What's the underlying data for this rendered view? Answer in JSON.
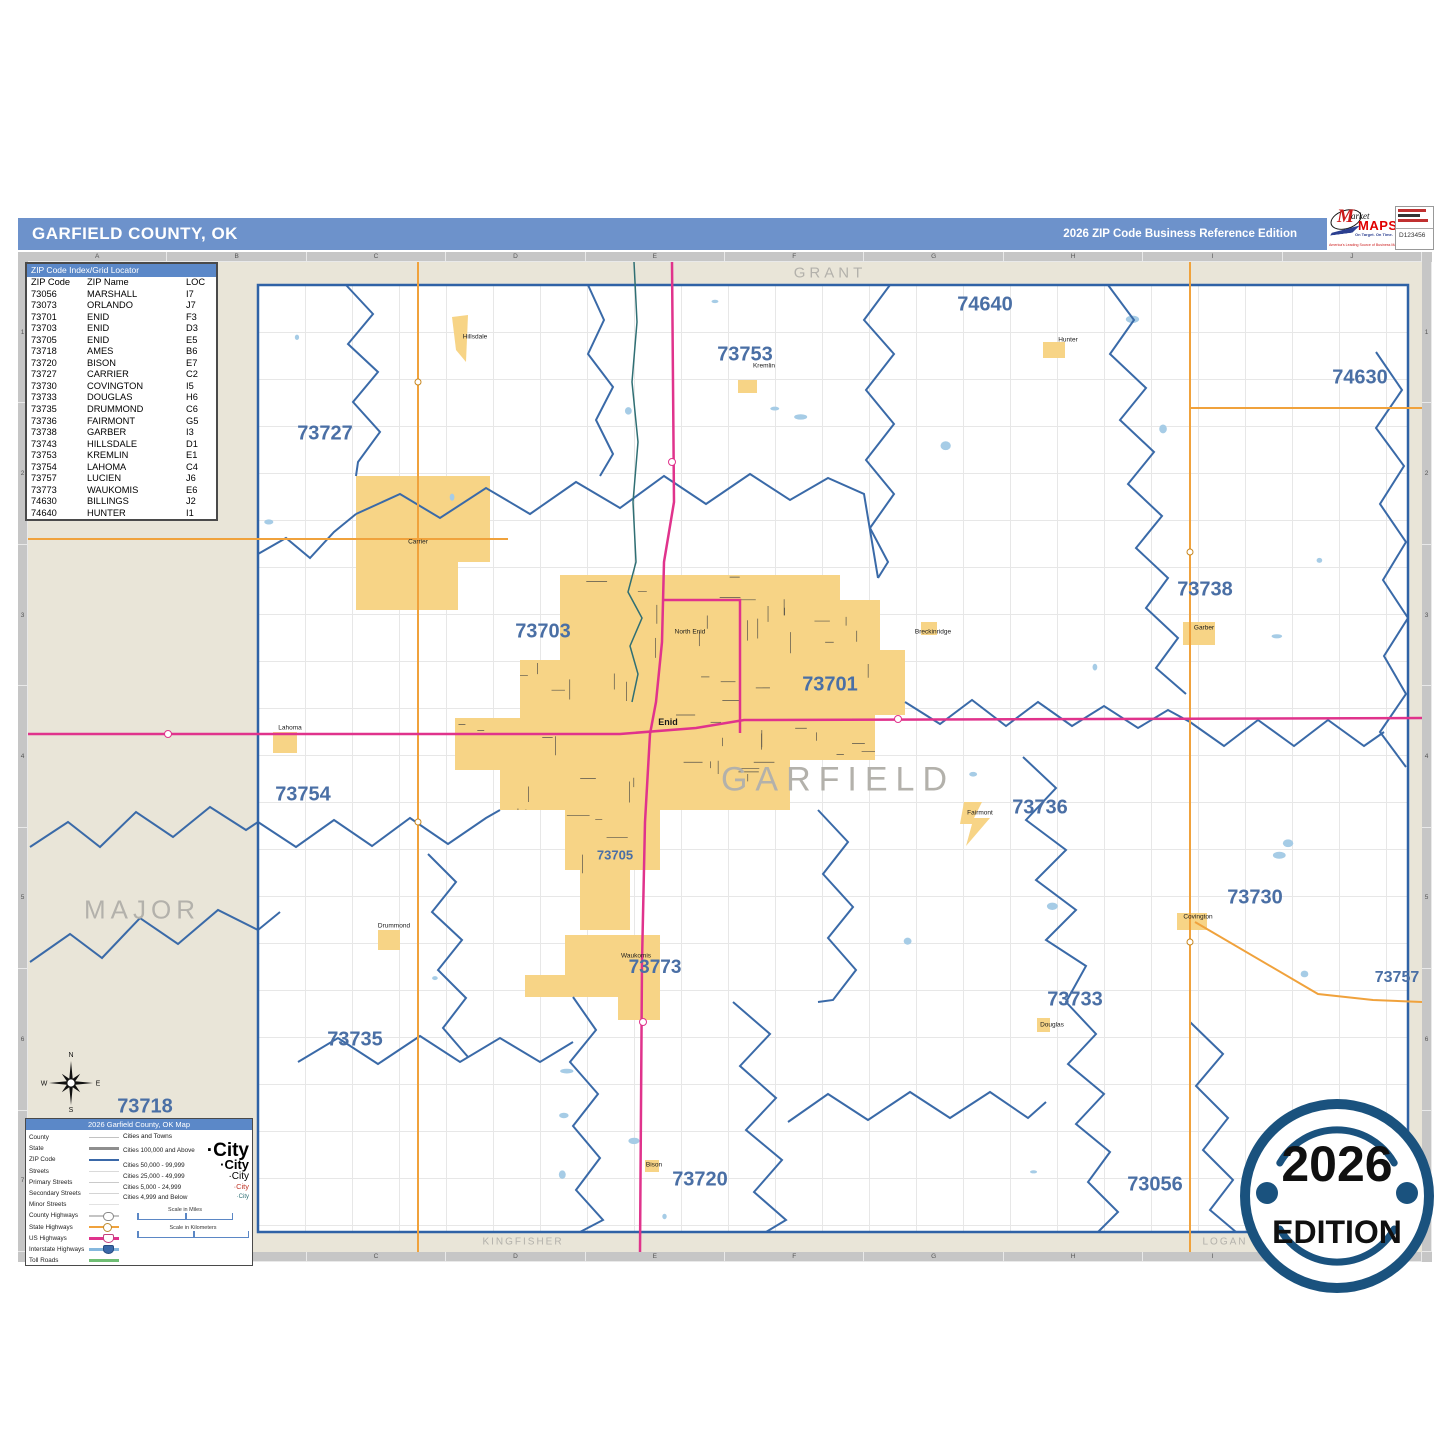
{
  "page": {
    "title_left": "GARFIELD COUNTY, OK",
    "title_right": "2026 ZIP Code Business Reference Edition"
  },
  "logo": {
    "m": "M",
    "arket": "arket",
    "maps": "MAPS",
    "tagline": "On Target. On Time.",
    "subline": "America's Leading Source of Business Maps",
    "product_code": "D123456"
  },
  "grid": {
    "col_letters": [
      "A",
      "B",
      "C",
      "D",
      "E",
      "F",
      "G",
      "H",
      "I",
      "J"
    ],
    "row_numbers": [
      "1",
      "2",
      "3",
      "4",
      "5",
      "6",
      "7"
    ]
  },
  "zip_index": {
    "header": "ZIP Code Index/Grid Locator",
    "columns": [
      "ZIP Code",
      "ZIP Name",
      "LOC"
    ],
    "rows": [
      [
        "73056",
        "MARSHALL",
        "I7"
      ],
      [
        "73073",
        "ORLANDO",
        "J7"
      ],
      [
        "73701",
        "ENID",
        "F3"
      ],
      [
        "73703",
        "ENID",
        "D3"
      ],
      [
        "73705",
        "ENID",
        "E5"
      ],
      [
        "73718",
        "AMES",
        "B6"
      ],
      [
        "73720",
        "BISON",
        "E7"
      ],
      [
        "73727",
        "CARRIER",
        "C2"
      ],
      [
        "73730",
        "COVINGTON",
        "I5"
      ],
      [
        "73733",
        "DOUGLAS",
        "H6"
      ],
      [
        "73735",
        "DRUMMOND",
        "C6"
      ],
      [
        "73736",
        "FAIRMONT",
        "G5"
      ],
      [
        "73738",
        "GARBER",
        "I3"
      ],
      [
        "73743",
        "HILLSDALE",
        "D1"
      ],
      [
        "73753",
        "KREMLIN",
        "E1"
      ],
      [
        "73754",
        "LAHOMA",
        "C4"
      ],
      [
        "73757",
        "LUCIEN",
        "J6"
      ],
      [
        "73773",
        "WAUKOMIS",
        "E6"
      ],
      [
        "74630",
        "BILLINGS",
        "J2"
      ],
      [
        "74640",
        "HUNTER",
        "I1"
      ]
    ]
  },
  "map": {
    "county_labels": [
      {
        "text": "GRANT",
        "x": 802,
        "y": 11,
        "size": 15,
        "ls": 4
      },
      {
        "text": "MAJOR",
        "x": 114,
        "y": 648,
        "size": 26,
        "ls": 5
      },
      {
        "text": "GARFIELD",
        "x": 810,
        "y": 518,
        "size": 34,
        "ls": 8
      },
      {
        "text": "KINGFISHER",
        "x": 495,
        "y": 980,
        "size": 10,
        "ls": 2
      },
      {
        "text": "LOGAN",
        "x": 1197,
        "y": 980,
        "size": 10,
        "ls": 2
      }
    ],
    "zip_labels": [
      {
        "text": "73727",
        "x": 297,
        "y": 172,
        "size": 20
      },
      {
        "text": "73753",
        "x": 717,
        "y": 93,
        "size": 20
      },
      {
        "text": "74640",
        "x": 957,
        "y": 43,
        "size": 20
      },
      {
        "text": "74630",
        "x": 1332,
        "y": 116,
        "size": 20
      },
      {
        "text": "73738",
        "x": 1177,
        "y": 328,
        "size": 20
      },
      {
        "text": "73703",
        "x": 515,
        "y": 370,
        "size": 20
      },
      {
        "text": "73701",
        "x": 802,
        "y": 423,
        "size": 20
      },
      {
        "text": "73754",
        "x": 275,
        "y": 533,
        "size": 20
      },
      {
        "text": "73736",
        "x": 1012,
        "y": 546,
        "size": 20
      },
      {
        "text": "73730",
        "x": 1227,
        "y": 636,
        "size": 20
      },
      {
        "text": "73705",
        "x": 587,
        "y": 593,
        "size": 13
      },
      {
        "text": "73773",
        "x": 627,
        "y": 706,
        "size": 19
      },
      {
        "text": "73733",
        "x": 1047,
        "y": 738,
        "size": 20
      },
      {
        "text": "73735",
        "x": 327,
        "y": 778,
        "size": 20
      },
      {
        "text": "73757",
        "x": 1369,
        "y": 716,
        "size": 16
      },
      {
        "text": "73718",
        "x": 117,
        "y": 845,
        "size": 20
      },
      {
        "text": "73720",
        "x": 672,
        "y": 918,
        "size": 20
      },
      {
        "text": "73056",
        "x": 1127,
        "y": 923,
        "size": 20
      }
    ],
    "town_labels": [
      {
        "text": "Enid",
        "x": 640,
        "y": 460,
        "size": 9,
        "bold": true
      },
      {
        "text": "North Enid",
        "x": 662,
        "y": 370,
        "size": 6.5
      },
      {
        "text": "Kremlin",
        "x": 736,
        "y": 104,
        "size": 6.5
      },
      {
        "text": "Hunter",
        "x": 1040,
        "y": 78,
        "size": 6.5
      },
      {
        "text": "Hillsdale",
        "x": 447,
        "y": 75,
        "size": 6.5
      },
      {
        "text": "Carrier",
        "x": 390,
        "y": 280,
        "size": 6.5
      },
      {
        "text": "Lahoma",
        "x": 262,
        "y": 466,
        "size": 6.5
      },
      {
        "text": "Drummond",
        "x": 366,
        "y": 664,
        "size": 6.5
      },
      {
        "text": "Waukomis",
        "x": 608,
        "y": 694,
        "size": 6.5
      },
      {
        "text": "Garber",
        "x": 1176,
        "y": 366,
        "size": 6.5
      },
      {
        "text": "Covington",
        "x": 1170,
        "y": 655,
        "size": 6.5
      },
      {
        "text": "Douglas",
        "x": 1024,
        "y": 763,
        "size": 6.5
      },
      {
        "text": "Fairmont",
        "x": 952,
        "y": 551,
        "size": 6.5
      },
      {
        "text": "Bison",
        "x": 626,
        "y": 903,
        "size": 6.5
      },
      {
        "text": "Breckinridge",
        "x": 905,
        "y": 370,
        "size": 6.5
      }
    ],
    "compass": {
      "n": "N",
      "e": "E",
      "s": "S",
      "w": "W"
    }
  },
  "legend": {
    "header": "2026 Garfield County, OK Map",
    "road_rows": [
      {
        "label": "County",
        "key": "county"
      },
      {
        "label": "State",
        "key": "state"
      },
      {
        "label": "ZIP Code",
        "key": "zip"
      },
      {
        "label": "Streets",
        "key": "streets"
      },
      {
        "label": "Primary Streets",
        "key": "primary"
      },
      {
        "label": "Secondary Streets",
        "key": "secondary"
      },
      {
        "label": "Minor Streets",
        "key": "minor"
      },
      {
        "label": "County Highways",
        "key": "countyhwy"
      },
      {
        "label": "State Highways",
        "key": "statehwy"
      },
      {
        "label": "US Highways",
        "key": "ushwy"
      },
      {
        "label": "Interstate Highways",
        "key": "interstate"
      },
      {
        "label": "Toll Roads",
        "key": "toll"
      }
    ],
    "cities_header": "Cities and Towns",
    "city_rows": [
      {
        "label": "Cities 100,000 and Above",
        "sample": "·City",
        "cls": "c1"
      },
      {
        "label": "Cities 50,000 - 99,999",
        "sample": "·City",
        "cls": "c2"
      },
      {
        "label": "Cities 25,000 - 49,999",
        "sample": "·City",
        "cls": "c3"
      },
      {
        "label": "Cities 5,000 - 24,999",
        "sample": "·City",
        "cls": "c4"
      },
      {
        "label": "Cities 4,999 and Below",
        "sample": "·City",
        "cls": "c5"
      }
    ],
    "scale_miles": "Scale in Miles",
    "scale_km": "Scale in Kilometers"
  },
  "badge": {
    "year": "2026",
    "edition": "EDITION"
  },
  "colors": {
    "title_bar": "#6D92CB",
    "header_bar": "#5B88C8",
    "margin_tan": "#E9E5D8",
    "zip_boundary": "#3A6AA8",
    "urban_yellow": "#F7D486",
    "us_highway": "#E0338C",
    "state_highway": "#F0A23C",
    "zip_label": "#4A6FA5",
    "county_label": "#B3B1AB",
    "badge_navy": "#1A527E"
  }
}
